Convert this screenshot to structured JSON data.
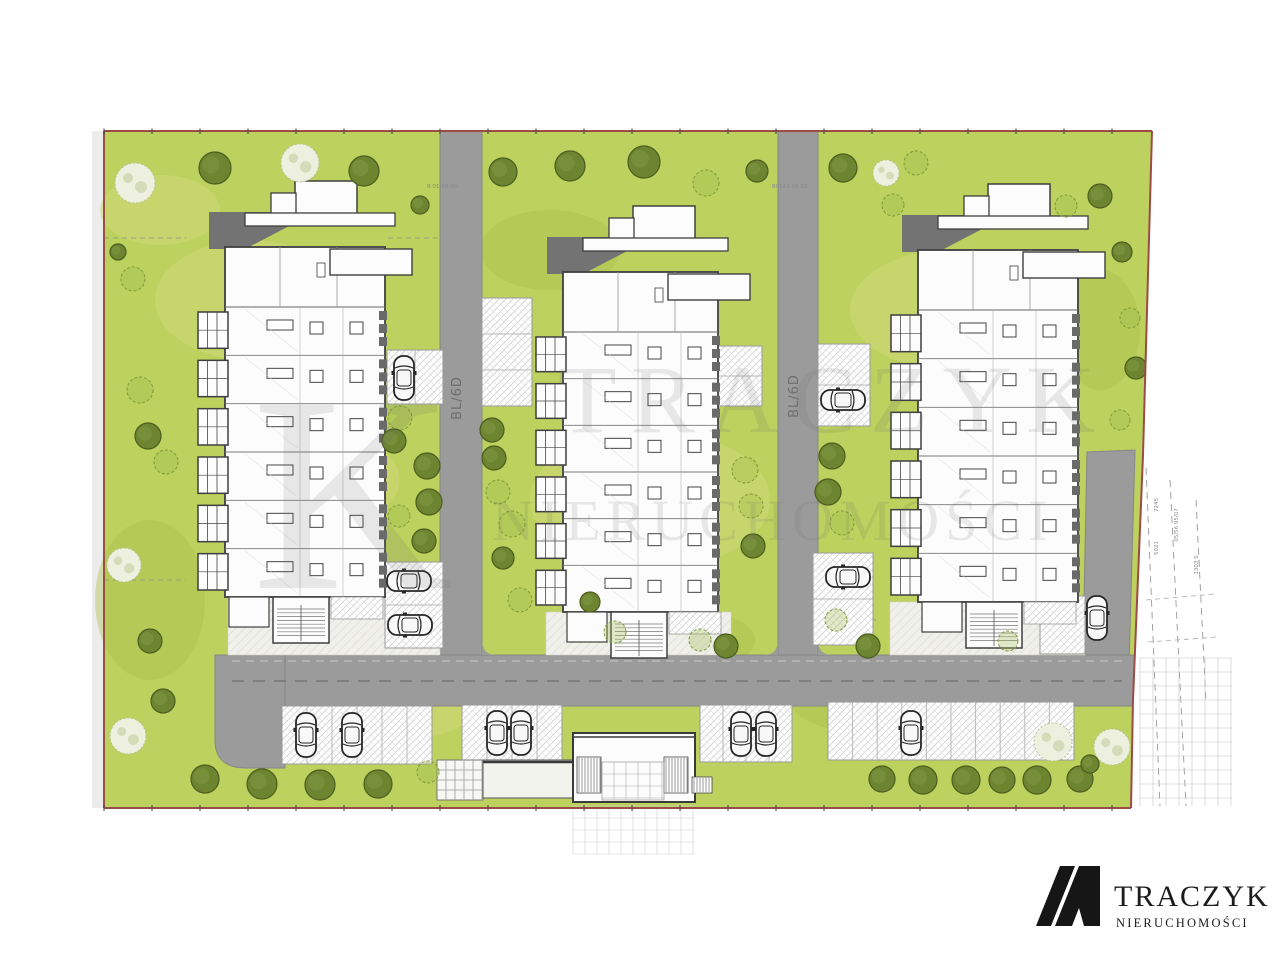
{
  "title": "Residential estate site plan",
  "colors": {
    "lawn": "#bcd15e",
    "lawnLight": "#cdda78",
    "lawnDark": "#a9c04b",
    "road": "#9b9b9b",
    "roadEdge": "#868686",
    "roadDash": "#757575",
    "walk": "#f0f0ea",
    "hatchLine": "#cccccc",
    "bayEdge": "#9a9a9a",
    "building": "#fcfcfc",
    "line": "#3f3f3f",
    "lineSoft": "#8a8a8a",
    "shadow": "#737373",
    "boundary": "#9c4b45",
    "tick": "#4a4a4a",
    "treeDark": "#6d8430",
    "treeDarkStroke": "#4c5e1f",
    "treeLight": "#edf0df",
    "treeLightStroke": "#b7c39a",
    "treeSketch": "#9ab84a",
    "treeSketchStroke": "#7e9a3a",
    "carBody": "#f8f8f8",
    "carLine": "#262626",
    "dim": "#8a8a8a",
    "roadtxt": "#6e6e6e",
    "wm": "#6f6f6f",
    "ink": "#1c1c1c"
  },
  "watermark": {
    "monogram": "K",
    "title": "TRACZYK",
    "subtitle": "NIERUCHOMOŚCI"
  },
  "logo": {
    "title": "TRACZYK",
    "subtitle": "NIERUCHOMOŚCI"
  },
  "roads": {
    "label_a": "BL/6D",
    "label_b": "BL/6D"
  },
  "dims": {
    "top_a": "B 01/68 BN",
    "top_b": "BI 1A1 98 DE",
    "right": [
      "7245",
      "5021",
      "05/56 95/07",
      "1303 S"
    ]
  }
}
